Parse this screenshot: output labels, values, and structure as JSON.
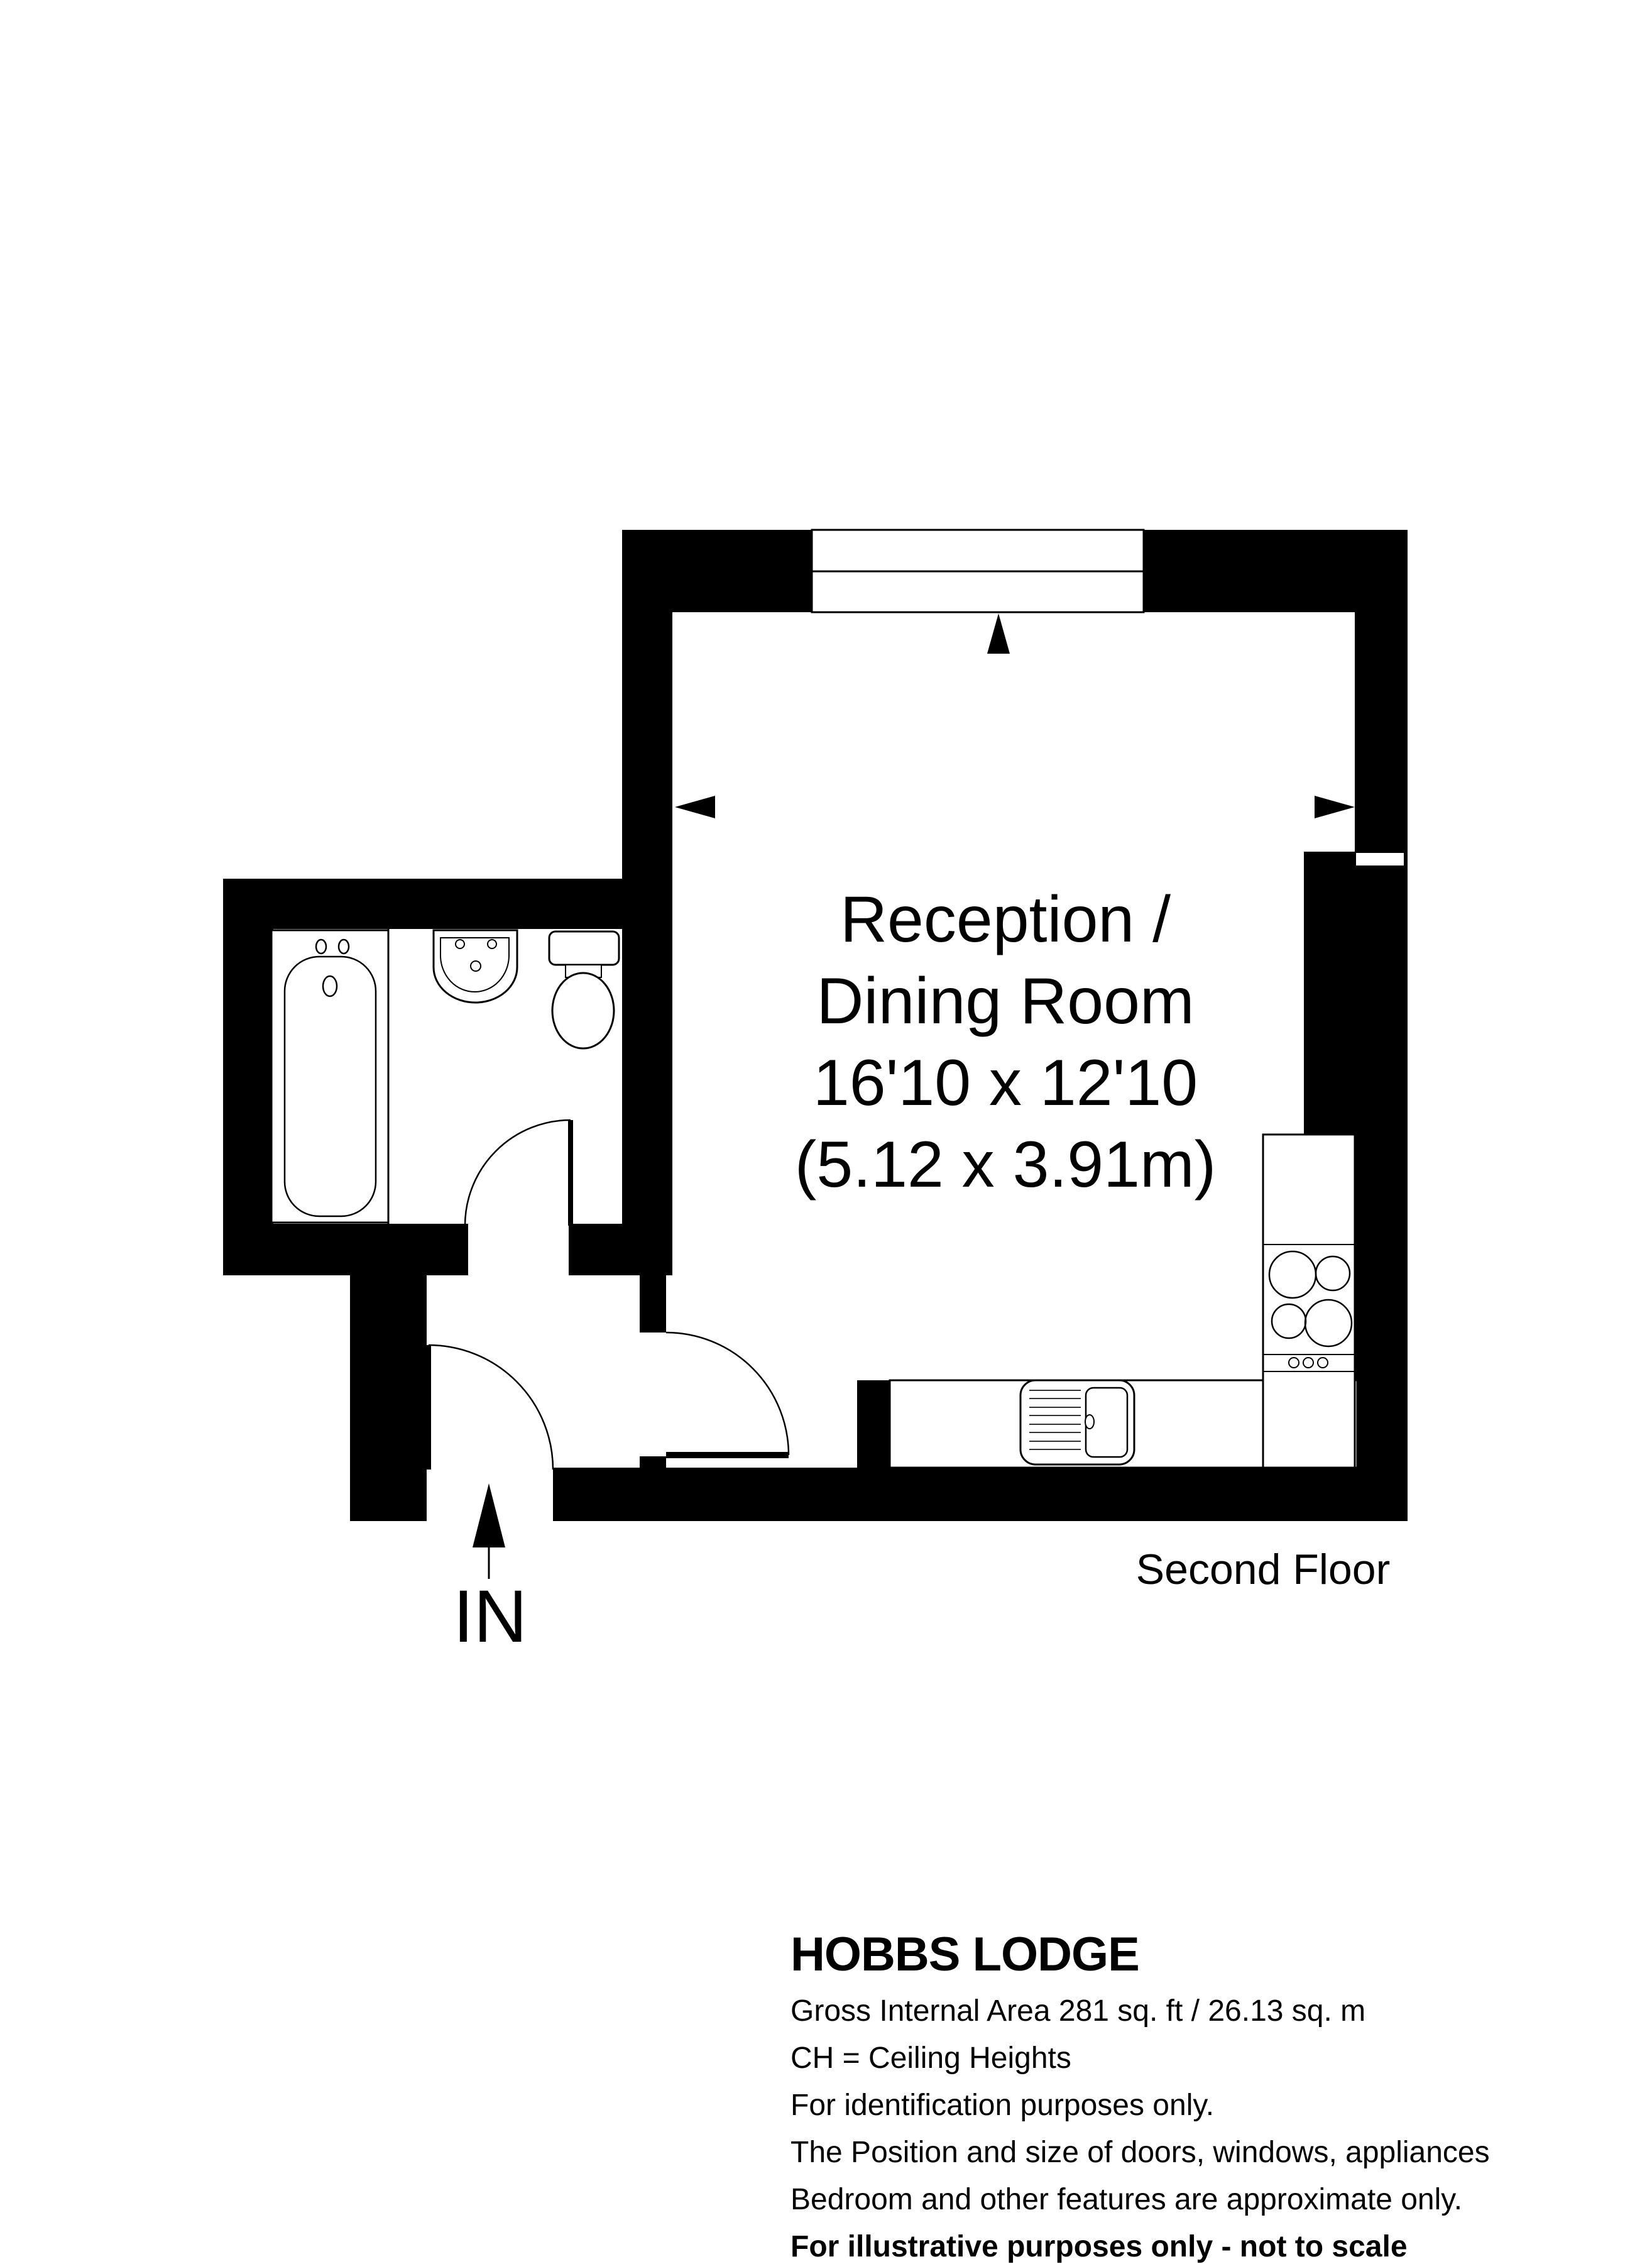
{
  "page": {
    "background": "#ffffff"
  },
  "plan": {
    "room_label": {
      "lines": [
        "Reception /",
        "Dining Room",
        "16'10 x 12'10",
        "(5.12 x 3.91m)"
      ]
    },
    "floor_label": "Second Floor",
    "entrance_label": "IN",
    "colors": {
      "wall": "#000000",
      "background": "#ffffff",
      "fixture_line": "#000000"
    },
    "fixtures": [
      "window",
      "bathtub",
      "pedestal-sink",
      "toilet",
      "hob",
      "kitchen-sink"
    ],
    "doors": [
      "entrance-door",
      "bathroom-door",
      "reception-door"
    ]
  },
  "footer": {
    "title": "HOBBS LODGE",
    "lines": [
      "Gross Internal Area 281 sq. ft / 26.13 sq. m",
      "CH = Ceiling Heights",
      "For identification purposes only.",
      "The Position and size of doors, windows, appliances",
      "Bedroom and other features are approximate only.",
      "For illustrative purposes only - not to scale"
    ]
  }
}
